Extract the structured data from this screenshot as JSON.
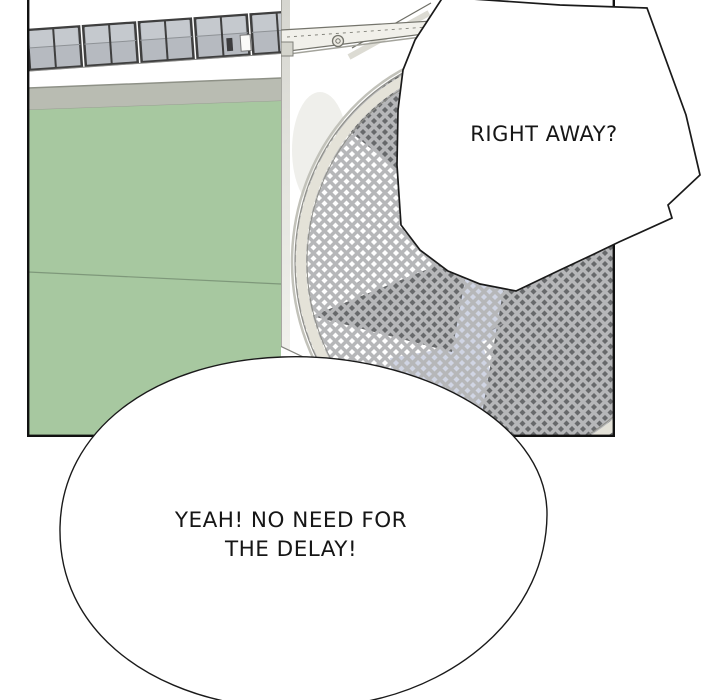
{
  "panel": {
    "description": "webtoon comic panel: building wall with window row, green lower wall, large circular exhaust fan with diamond lattice grille"
  },
  "bubbles": {
    "shout": {
      "text": "RIGHT AWAY?"
    },
    "reply": {
      "line1": "YEAH! NO NEED FOR",
      "line2": "THE DELAY!"
    }
  },
  "colors": {
    "green_wall": "#a7c8a0",
    "green_seam": "#7e987a",
    "gray_band": "#b9bcb2",
    "window_glass": "#b6bac0",
    "lattice_bar": "#b6b7b9",
    "blade_dark": "#67696b",
    "blade_light": "#d0d5e4",
    "rim_band": "#e4e2d8",
    "bubble_fill": "#ffffff",
    "outline": "#1a1a1a"
  }
}
